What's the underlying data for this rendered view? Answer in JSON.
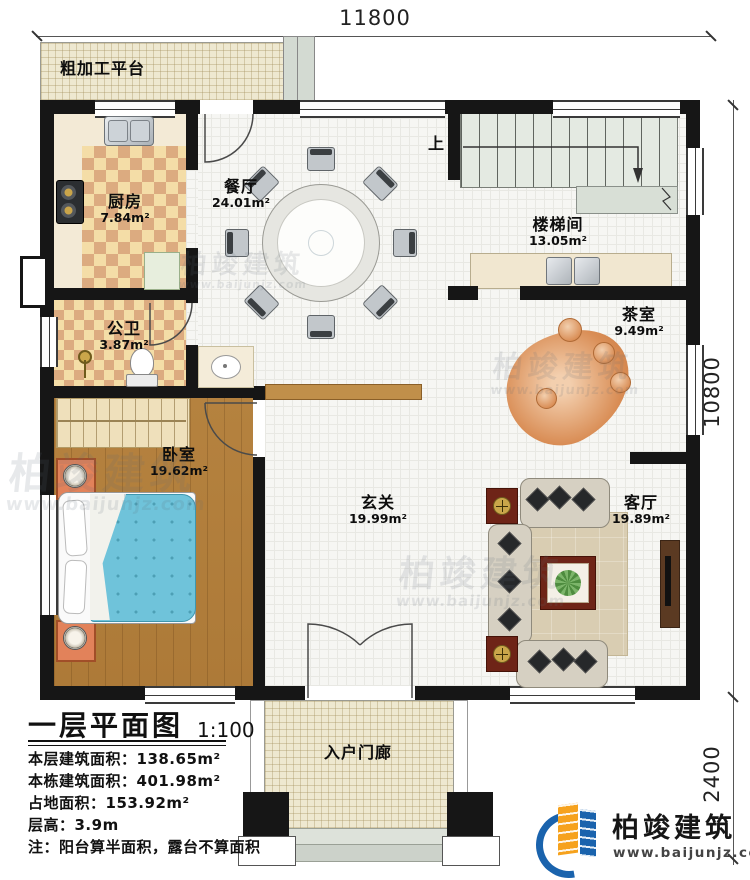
{
  "dimensions": {
    "top": "11800",
    "side_main": "10800",
    "side_porch": "2400"
  },
  "rooms": {
    "platform": {
      "name": "粗加工平台"
    },
    "kitchen": {
      "name": "厨房",
      "area": "7.84m²"
    },
    "dining": {
      "name": "餐厅",
      "area": "24.01m²"
    },
    "stairwell": {
      "name": "楼梯间",
      "area": "13.05m²"
    },
    "tearoom": {
      "name": "茶室",
      "area": "9.49m²"
    },
    "bath": {
      "name": "公卫",
      "area": "3.87m²"
    },
    "bedroom": {
      "name": "卧室",
      "area": "19.62m²"
    },
    "foyer": {
      "name": "玄关",
      "area": "19.99m²"
    },
    "living": {
      "name": "客厅",
      "area": "19.89m²"
    },
    "porch": {
      "name": "入户门廊"
    }
  },
  "stairs": {
    "up_label": "上"
  },
  "title_block": {
    "title": "一层平面图",
    "scale": "1:100",
    "lines": [
      "本层建筑面积：138.65m²",
      "本栋建筑面积：401.98m²",
      "占地面积：153.92m²",
      "层高：3.9m",
      "注：阳台算半面积，露台不算面积"
    ]
  },
  "brand": {
    "name": "柏竣建筑",
    "url": "www.baijunjz.com"
  },
  "watermark": {
    "name": "柏竣建筑",
    "url": "www.baijunjz.com"
  },
  "colors": {
    "wall": "#161616",
    "checker_light": "#f4dda7",
    "checker_dark": "#dcab80",
    "wood_floor": "#b5823f",
    "bed_quilt": "#6fc3da",
    "nightstand": "#e2825a",
    "stair_fill": "#e4eae2",
    "tea_table": "#d98d55",
    "logo_blue": "#1a63ad",
    "logo_orange": "#f6a21d"
  }
}
